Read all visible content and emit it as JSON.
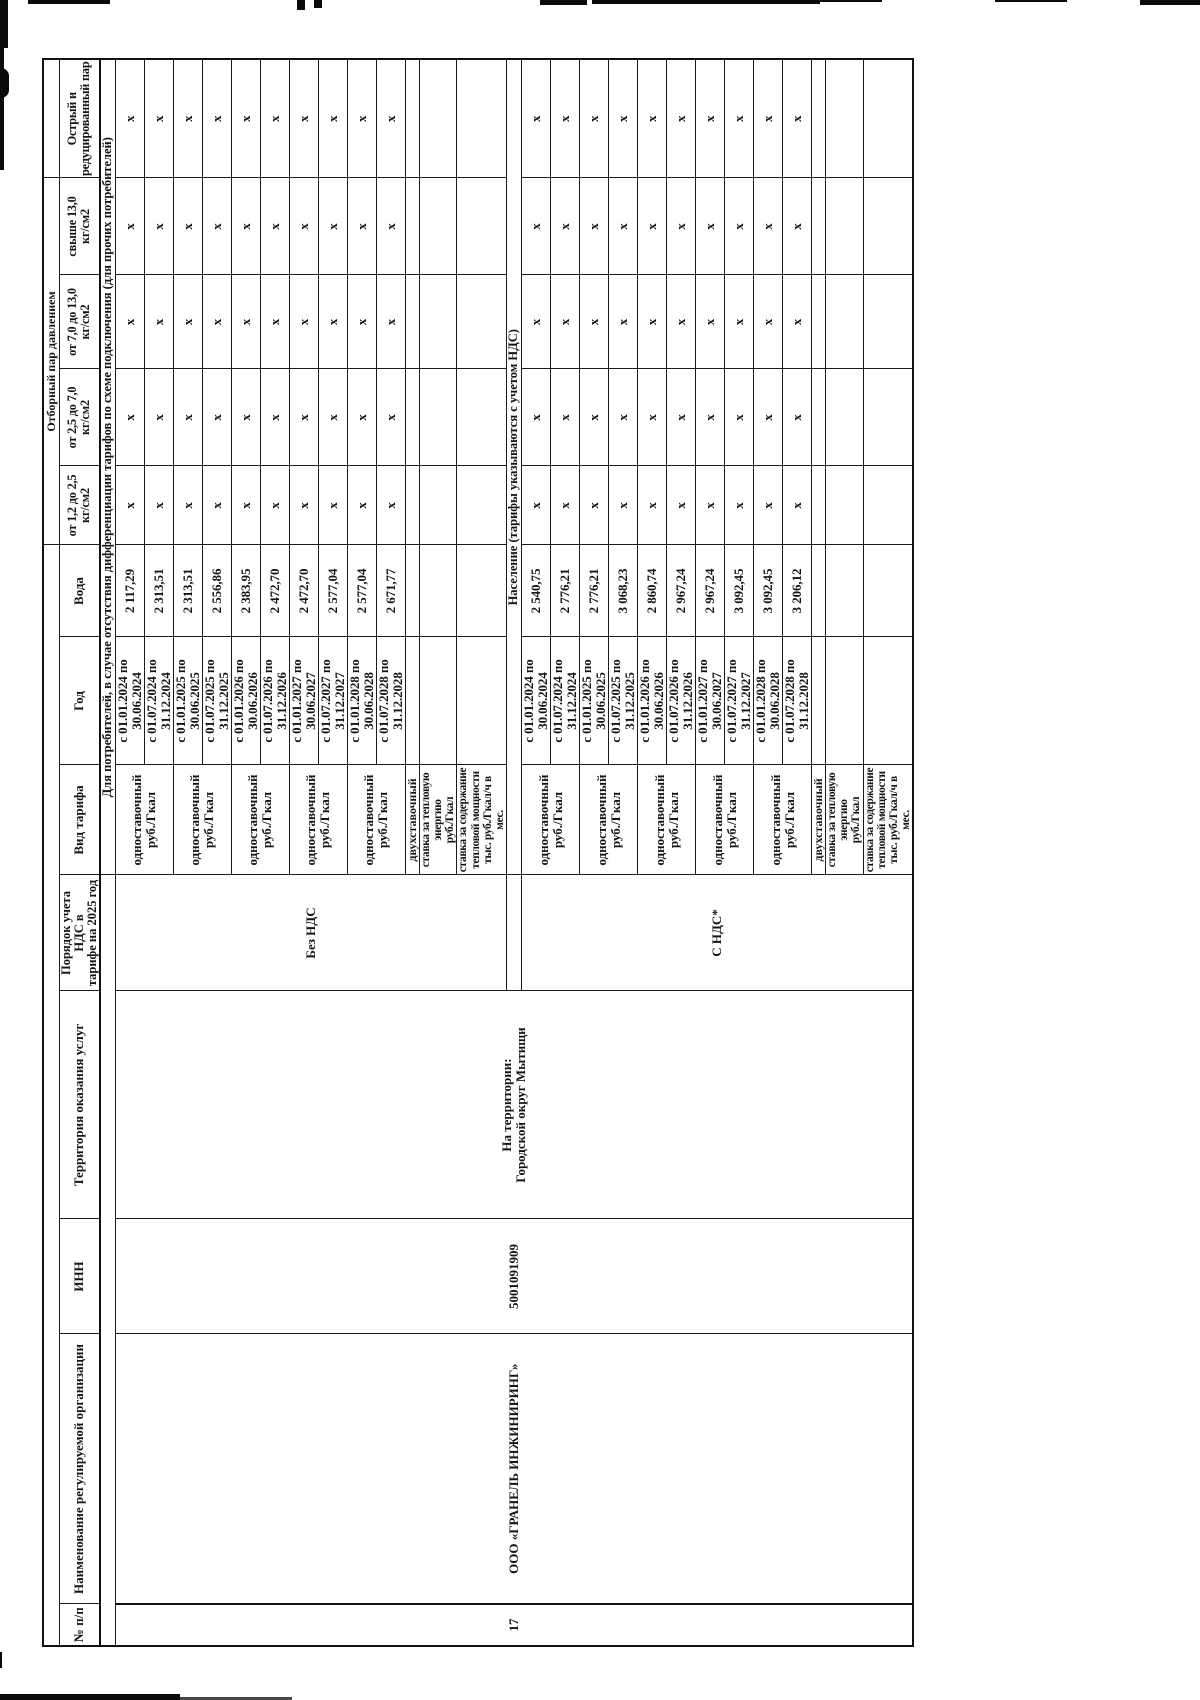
{
  "table": {
    "group_header": "Отборный пар давлением",
    "headers": {
      "num": "№ п/п",
      "org": "Наименование регулируемой организации",
      "inn": "ИНН",
      "territory": "Территория оказания услуг",
      "vat": "Порядок учета НДС в\nтарифе на 2025 год",
      "tariff_type": "Вид тарифа",
      "year": "Год",
      "water": "Вода",
      "p1": "от 1,2 до 2,5\nкг/см2",
      "p2": "от 2,5 до 7,0\nкг/см2",
      "p3": "от 7,0 до 13,0\nкг/см2",
      "p4": "свыше 13,0\nкг/см2",
      "steam": "Острый и\nредуцированный пар"
    },
    "entry": {
      "num": "17",
      "org": "ООО «ГРАНЕЛЬ ИНЖИНИРИНГ»",
      "inn": "5001091909",
      "territory": "На территории:\nГородской округ Мытищи"
    },
    "x_mark": "х",
    "sections": [
      {
        "name": "Для потребителей, в случае отсутствия дифференциации тарифов по схеме подключения (для прочих потребителей)",
        "vat": "Без НДС",
        "tariff_label": "одноставочный\nруб./Гкал",
        "periods": [
          {
            "year": "с 01.01.2024 по\n30.06.2024",
            "water": "2 117,29"
          },
          {
            "year": "с 01.07.2024 по\n31.12.2024",
            "water": "2 313,51"
          },
          {
            "year": "с 01.01.2025 по\n30.06.2025",
            "water": "2 313,51"
          },
          {
            "year": "с 01.07.2025 по\n31.12.2025",
            "water": "2 556,86"
          },
          {
            "year": "с 01.01.2026 по\n30.06.2026",
            "water": "2 383,95"
          },
          {
            "year": "с 01.07.2026 по\n31.12.2026",
            "water": "2 472,70"
          },
          {
            "year": "с 01.01.2027 по\n30.06.2027",
            "water": "2 472,70"
          },
          {
            "year": "с 01.07.2027 по\n31.12.2027",
            "water": "2 577,04"
          },
          {
            "year": "с 01.01.2028 по\n30.06.2028",
            "water": "2 577,04"
          },
          {
            "year": "с 01.07.2028 по\n31.12.2028",
            "water": "2 671,77"
          }
        ],
        "extra_rows": [
          "двухставочный",
          "ставка за тепловую\nэнергию\nруб./Гкал",
          "ставка за содержание\nтепловой мощности\nтыс. руб./Гкал/ч в мес."
        ]
      },
      {
        "name": "Население (тарифы указываются с учетом НДС)",
        "vat": "С НДС*",
        "tariff_label": "одноставочный\nруб./Гкал",
        "periods": [
          {
            "year": "с 01.01.2024 по\n30.06.2024",
            "water": "2 540,75"
          },
          {
            "year": "с 01.07.2024 по\n31.12.2024",
            "water": "2 776,21"
          },
          {
            "year": "с 01.01.2025 по\n30.06.2025",
            "water": "2 776,21"
          },
          {
            "year": "с 01.07.2025 по\n31.12.2025",
            "water": "3 068,23"
          },
          {
            "year": "с 01.01.2026 по\n30.06.2026",
            "water": "2 860,74"
          },
          {
            "year": "с 01.07.2026 по\n31.12.2026",
            "water": "2 967,24"
          },
          {
            "year": "с 01.01.2027 по\n30.06.2027",
            "water": "2 967,24"
          },
          {
            "year": "с 01.07.2027 по\n31.12.2027",
            "water": "3 092,45"
          },
          {
            "year": "с 01.01.2028 по\n30.06.2028",
            "water": "3 092,45"
          },
          {
            "year": "с 01.07.2028 по\n31.12.2028",
            "water": "3 206,12"
          }
        ],
        "extra_rows": [
          "двухставочный",
          "ставка за тепловую\nэнергию\nруб./Гкал",
          "ставка за содержание\nтепловой мощности\nтыс. руб./Гкал/ч в мес."
        ]
      }
    ]
  }
}
